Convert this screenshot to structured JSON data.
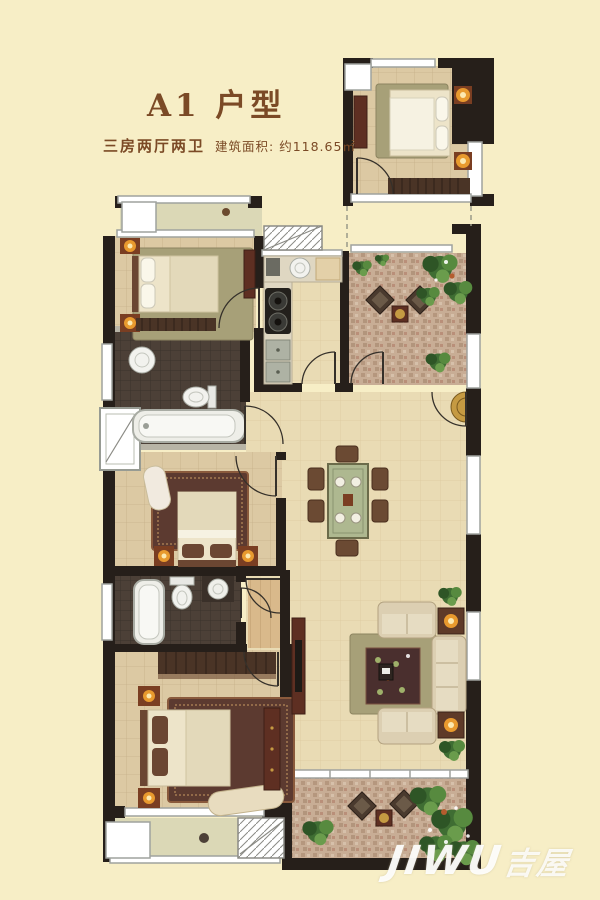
{
  "header": {
    "title": "A1 户型",
    "specs": "三房两厅两卫",
    "area_label": "建筑面积: 约118.65㎡"
  },
  "watermark": {
    "latin": "JIWU",
    "cn": "吉屋"
  },
  "palette": {
    "background": "#F7EEC6",
    "title_brown": "#7B4A26",
    "wall_black": "#261F1A",
    "floor_tile": "#DCC9A3",
    "floor_light": "#E9DBB4",
    "stone_floor": "#C8AD95",
    "bath_tile": "#4C4037",
    "balcony_floor": "#DBD8B6",
    "wood_floor": "#D9B98B",
    "furniture_wood": "#5E2F22",
    "linen": "#EDE4C9",
    "rug_olive": "#A7A078",
    "rug_dark": "#5C3A30",
    "plant_green": "#3F6D33",
    "lamp_glow": "#E89A2E",
    "watermark_white": "#FFFFFF"
  }
}
